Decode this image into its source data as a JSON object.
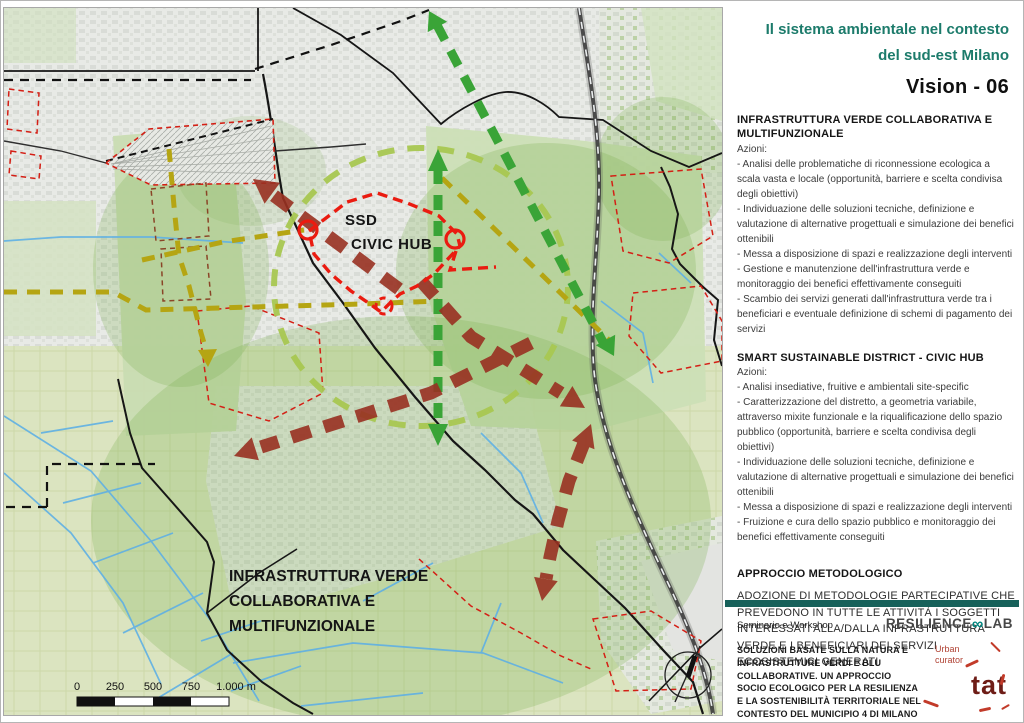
{
  "panel": {
    "title_line1": "Il sistema ambientale nel contesto",
    "title_line2": "del sud-est Milano",
    "vision": "Vision - 06",
    "sections": [
      {
        "heading": "INFRASTRUTTURA VERDE COLLABORATIVA E MULTIFUNZIONALE",
        "intro": "Azioni:",
        "items": [
          "- Analisi delle problematiche di riconnessione ecologica a scala vasta e locale (opportunità, barriere e scelta condivisa degli obiettivi)",
          "- Individuazione delle soluzioni tecniche, definizione e valutazione di alternative progettuali e simulazione dei benefici ottenibili",
          "- Messa a disposizione di spazi e realizzazione degli interventi",
          "- Gestione e manutenzione dell'infrastruttura verde e monitoraggio dei benefici effettivamente conseguiti",
          "- Scambio dei servizi generati dall'infrastruttura verde tra i beneficiari e eventuale definizione di schemi di pagamento dei servizi"
        ]
      },
      {
        "heading": "SMART SUSTAINABLE DISTRICT - CIVIC HUB",
        "intro": "Azioni:",
        "items": [
          "- Analisi insediative, fruitive e ambientali site-specific",
          "- Caratterizzazione del distretto, a geometria variabile, attraverso mixite funzionale e la riqualificazione dello spazio pubblico (opportunità, barriere e scelta condivisa degli obiettivi)",
          "- Individuazione delle soluzioni tecniche, definizione e valutazione di alternative progettuali e simulazione dei benefici ottenibili",
          "- Messa a disposizione di spazi e realizzazione degli interventi",
          "- Fruizione e cura dello spazio pubblico e monitoraggio dei benefici effettivamente conseguiti"
        ]
      },
      {
        "heading": "APPROCCIO METODOLOGICO",
        "body": "ADOZIONE DI METODOLOGIE PARTECIPATIVE CHE PREVEDONO IN TUTTE LE ATTIVITÀ I SOGGETTI INTERESSATI ALLA/DALLA INFRASTRUTTURA VERDE E I BENEFICIARI DEI SERVIZI ECOSISTEMICI GENERATI"
      }
    ],
    "footer": {
      "event_type": "Seminario e Workshop",
      "brand_resilience_part1": "RESILIENCE",
      "brand_resilience_infinity": "∞",
      "brand_resilience_part2": "LAB",
      "event_title": "SOLUZIONI BASATE SULLA NATURA E INFRASTRUTTURE VERDI E BLU COLLABORATIVE. UN APPROCCIO SOCIO ECOLOGICO PER LA RESILIENZA E LA SOSTENIBILITÀ TERRITORIALE NEL CONTESTO DEL MUNICIPIO 4 DI MILANO",
      "event_date": "12 novembre 2021 - Municipio 4",
      "brand_urban_curator_line1": "Urban",
      "brand_urban_curator_line2": "curator",
      "brand_tat": "tat"
    }
  },
  "map": {
    "labels": {
      "ssd_line1": "SSD",
      "ssd_line2": "CIVIC HUB",
      "infra_line1": "INFRASTRUTTURA VERDE",
      "infra_line2": "COLLABORATIVA E",
      "infra_line3": "MULTIFUNZIONALE"
    },
    "scale_ticks": [
      "0",
      "250",
      "500",
      "750",
      "1.000 m"
    ],
    "colors": {
      "title_teal": "#1c7b6b",
      "footer_bar_teal": "#17615a",
      "resilience_infinity_teal": "#00857e",
      "green_arrow": "#3aa437",
      "lime_dashed_ring": "#a8c751",
      "mustard_dashed": "#b5a513",
      "maroon_arrow": "#993122",
      "civic_hub_outline": "#ea1b10",
      "thin_red_dashed": "#d41f15",
      "canal_blue": "#5fb0e4",
      "tat_maroon": "#6e1d17"
    }
  }
}
